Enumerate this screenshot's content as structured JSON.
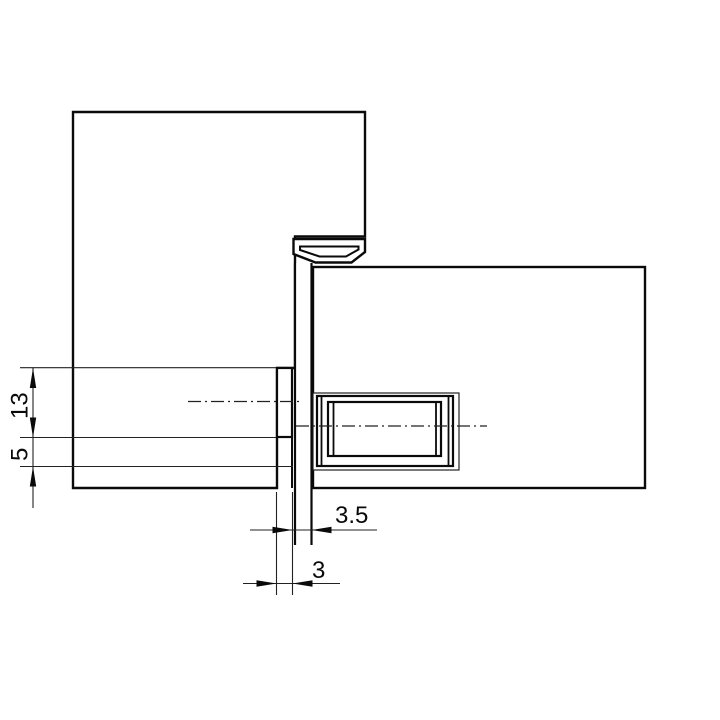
{
  "drawing": {
    "title": "concealed-hinge-cross-section",
    "background_color": "#ffffff",
    "line_color": "#0a0a0a",
    "thin_line_color": "#222222",
    "parts": {
      "door_leaf": "door leaf (upper-left panel)",
      "frame": "frame (right panel)",
      "knuckle": "hinge knuckle cap",
      "plate": "hinge link plate",
      "door_body": "hinge body in door leaf",
      "frame_body": "hinge body in frame"
    },
    "dimensions": {
      "dim_13": {
        "label": "13",
        "orientation": "vertical"
      },
      "dim_5": {
        "label": "5",
        "orientation": "vertical"
      },
      "dim_3_5": {
        "label": "3.5",
        "orientation": "horizontal"
      },
      "dim_3": {
        "label": "3",
        "orientation": "horizontal"
      }
    }
  }
}
